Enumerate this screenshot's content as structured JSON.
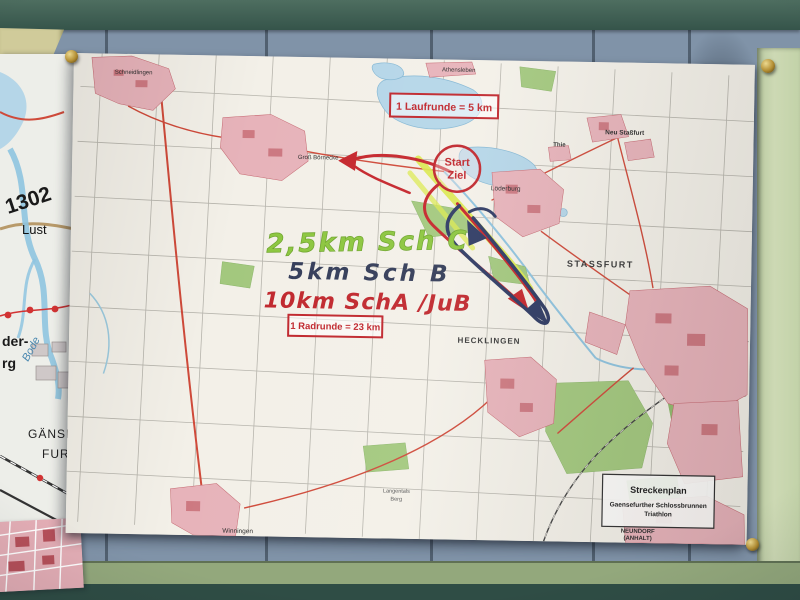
{
  "paper": {
    "boxes": {
      "laufrunde": "1 Laufrunde = 5 km",
      "radrunde": "1 Radrunde = 23 km"
    },
    "start_ziel": {
      "line1": "Start",
      "line2": "Ziel"
    },
    "courses": {
      "green": "2,5km Sch C",
      "blue": "5km Sch B",
      "red": "10km SchA /JuB"
    },
    "legend": {
      "title": "Streckenplan",
      "line1": "Gaensefurther Schlossbrunnen",
      "line2": "Triathlon"
    },
    "towns": {
      "schneidlingen": "Schneidlingen",
      "gross_boernecke": "Groß Börnecke",
      "athensleben": "Athensleben",
      "neu_stassfurt": "Neu Staßfurt",
      "thie": "Thie",
      "loederburg": "Löderburg",
      "stassfurt": "STASSFURT",
      "hecklingen": "HECKLINGEN",
      "winningen": "Winningen",
      "langentals_line1": "Langentals",
      "langentals_line2": "Berg",
      "neundorf_line1": "NEUNDORF",
      "neundorf_line2": "(ANHALT)"
    }
  },
  "left_sheet": {
    "road_number": "1302",
    "lust": "Lust",
    "bode": "Bode",
    "fragment1": "der-",
    "fragment2": "rg",
    "gaensefurth_line1": "GÄNSE",
    "gaensefurth_line2": "FURT"
  },
  "colors": {
    "bike_route_red": "#c5262c",
    "run_route_blue": "#2e3a63",
    "course_highlight_yellow": "#dce94e",
    "handwriting_green": "#8cc63f",
    "annotation_red": "#c0272d",
    "board_blue": "#8093a8",
    "plank_green": "#c9d7ae",
    "beam_teal": "#3c5a50"
  }
}
